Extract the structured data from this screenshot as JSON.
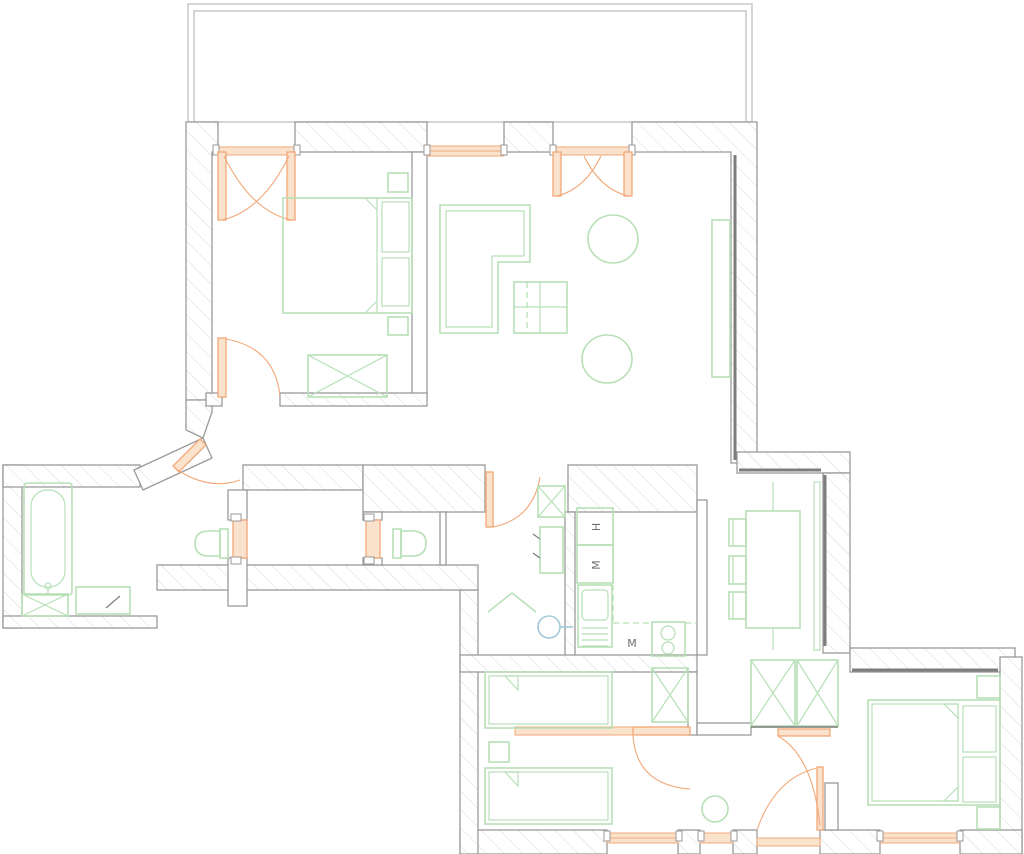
{
  "plan": {
    "title": "apartment-floor-plan",
    "labels": {
      "appliance_h": "H",
      "appliance_m_upper": "M",
      "appliance_m_lower": "M"
    },
    "colors": {
      "background": "#ffffff",
      "walls": "#9a9a9a",
      "hatch": "#dcdcdc",
      "wall_dark": "#7d7d7d",
      "balcony": "#c8c8c8",
      "furniture": "#b7e0b7",
      "door": "#f2a878",
      "door_fill": "#fbe2cd",
      "fixture": "#a3c8d8",
      "label_text": "#6f6f6f"
    },
    "symbols": [
      "balcony-outline",
      "double-bed",
      "single-bed",
      "pillow",
      "nightstand",
      "wardrobe-crossed",
      "sofa-corner",
      "coffee-table",
      "round-pouf",
      "tv-stand",
      "dining-table",
      "chair",
      "console",
      "bathtub",
      "washing-machine",
      "vanity-counter",
      "toilet",
      "washbasin",
      "fridge",
      "kitchen-cabinet",
      "kitchen-sink",
      "stove-two-burners",
      "swing-door",
      "double-balcony-door",
      "pocket-door",
      "window"
    ]
  }
}
